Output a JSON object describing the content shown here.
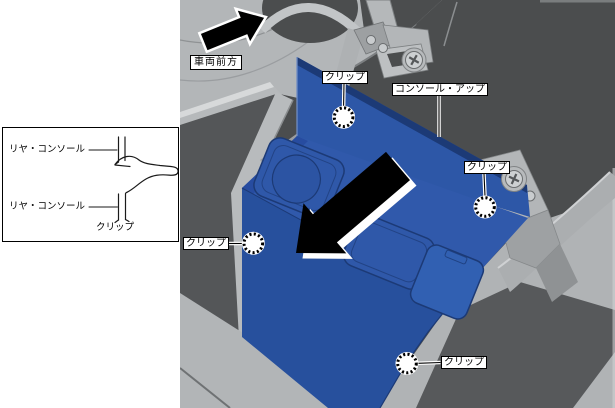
{
  "inset": {
    "labels": {
      "rear_console_top": "リヤ・コンソール",
      "rear_console_bottom": "リヤ・コンソール",
      "clip": "クリップ"
    }
  },
  "main": {
    "vehicle_front_label": "車両前方",
    "callouts": {
      "clip_top": "クリップ",
      "console_up": "コンソール・アップ",
      "clip_right": "クリップ",
      "clip_left": "クリップ",
      "clip_bottom": "クリップ"
    },
    "colors": {
      "highlight_blue": "#2d57a7",
      "highlight_blue_dark": "#1c3a76",
      "background_dark_gray": "#4b4d4e",
      "trim_light_gray": "#b3b6b8",
      "floor_gray": "#b2b5b7",
      "arrow_black": "#000000"
    }
  }
}
